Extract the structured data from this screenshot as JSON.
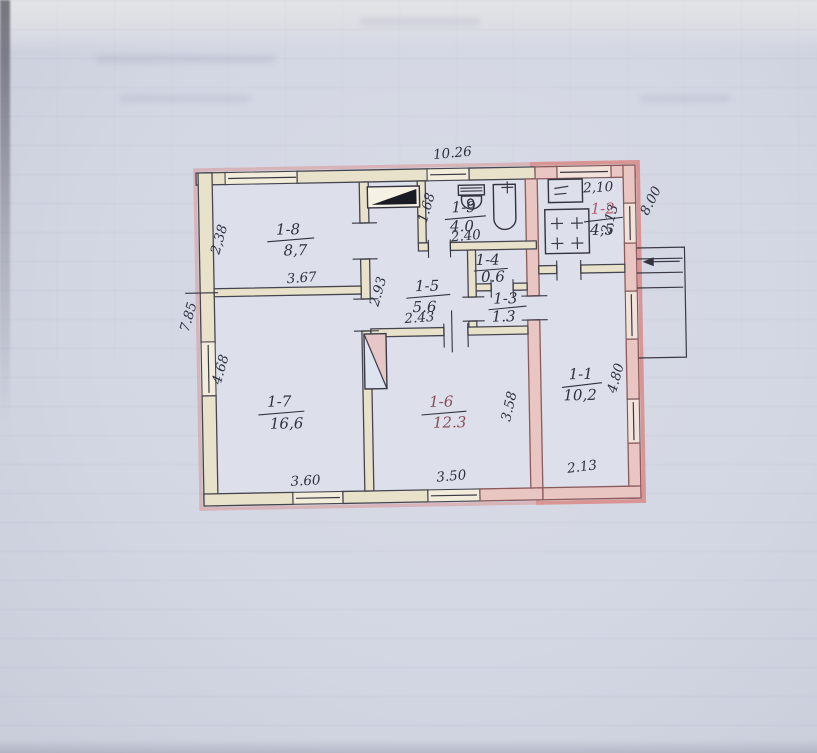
{
  "plan": {
    "overall_dims": {
      "top_width": "10.26",
      "left_height": "7.85",
      "right_side": "8.00"
    },
    "rooms": [
      {
        "id": "1-8",
        "area": "8,7",
        "dim_left": "2,38",
        "dim_bottom": "3.67"
      },
      {
        "id": "1-7",
        "area": "16,6",
        "dim_left": "4.68",
        "dim_bottom": "3.60"
      },
      {
        "id": "1-5",
        "area": "5.6",
        "dim_left": "2.93",
        "dim_bottom": "2.43"
      },
      {
        "id": "1-9",
        "area": "4.0",
        "dim_left": "1.68",
        "dim_bottom": "2.40"
      },
      {
        "id": "1-4",
        "area": "0.6"
      },
      {
        "id": "1-3",
        "area": "1.3"
      },
      {
        "id": "1-6",
        "area": "12.3",
        "dim_right": "3.58",
        "dim_bottom": "3.50"
      },
      {
        "id": "1-2",
        "area": "4,5",
        "dim_top": "2,10",
        "dim_right": "2,13"
      },
      {
        "id": "1-1",
        "area": "10,2",
        "dim_right": "4.80",
        "dim_bottom": "2.13"
      }
    ],
    "icons": {
      "furnace": "furnace-icon",
      "heater": "corner-heater-icon",
      "toilet": "toilet-icon",
      "bathtub": "bathtub-icon",
      "sink": "sink-icon",
      "stove": "stove-burners-icon",
      "entrance_arrow": "entrance-arrow-icon",
      "porch_steps": "porch-steps-icon"
    },
    "colors": {
      "paper": "#d4d8e4",
      "wall_fill": "#e9e2cb",
      "annex_wall_fill": "#eac6c2",
      "pink_accent": "#d98f8d",
      "ink": "#2e3140",
      "red_ink": "#b25a6e"
    }
  }
}
